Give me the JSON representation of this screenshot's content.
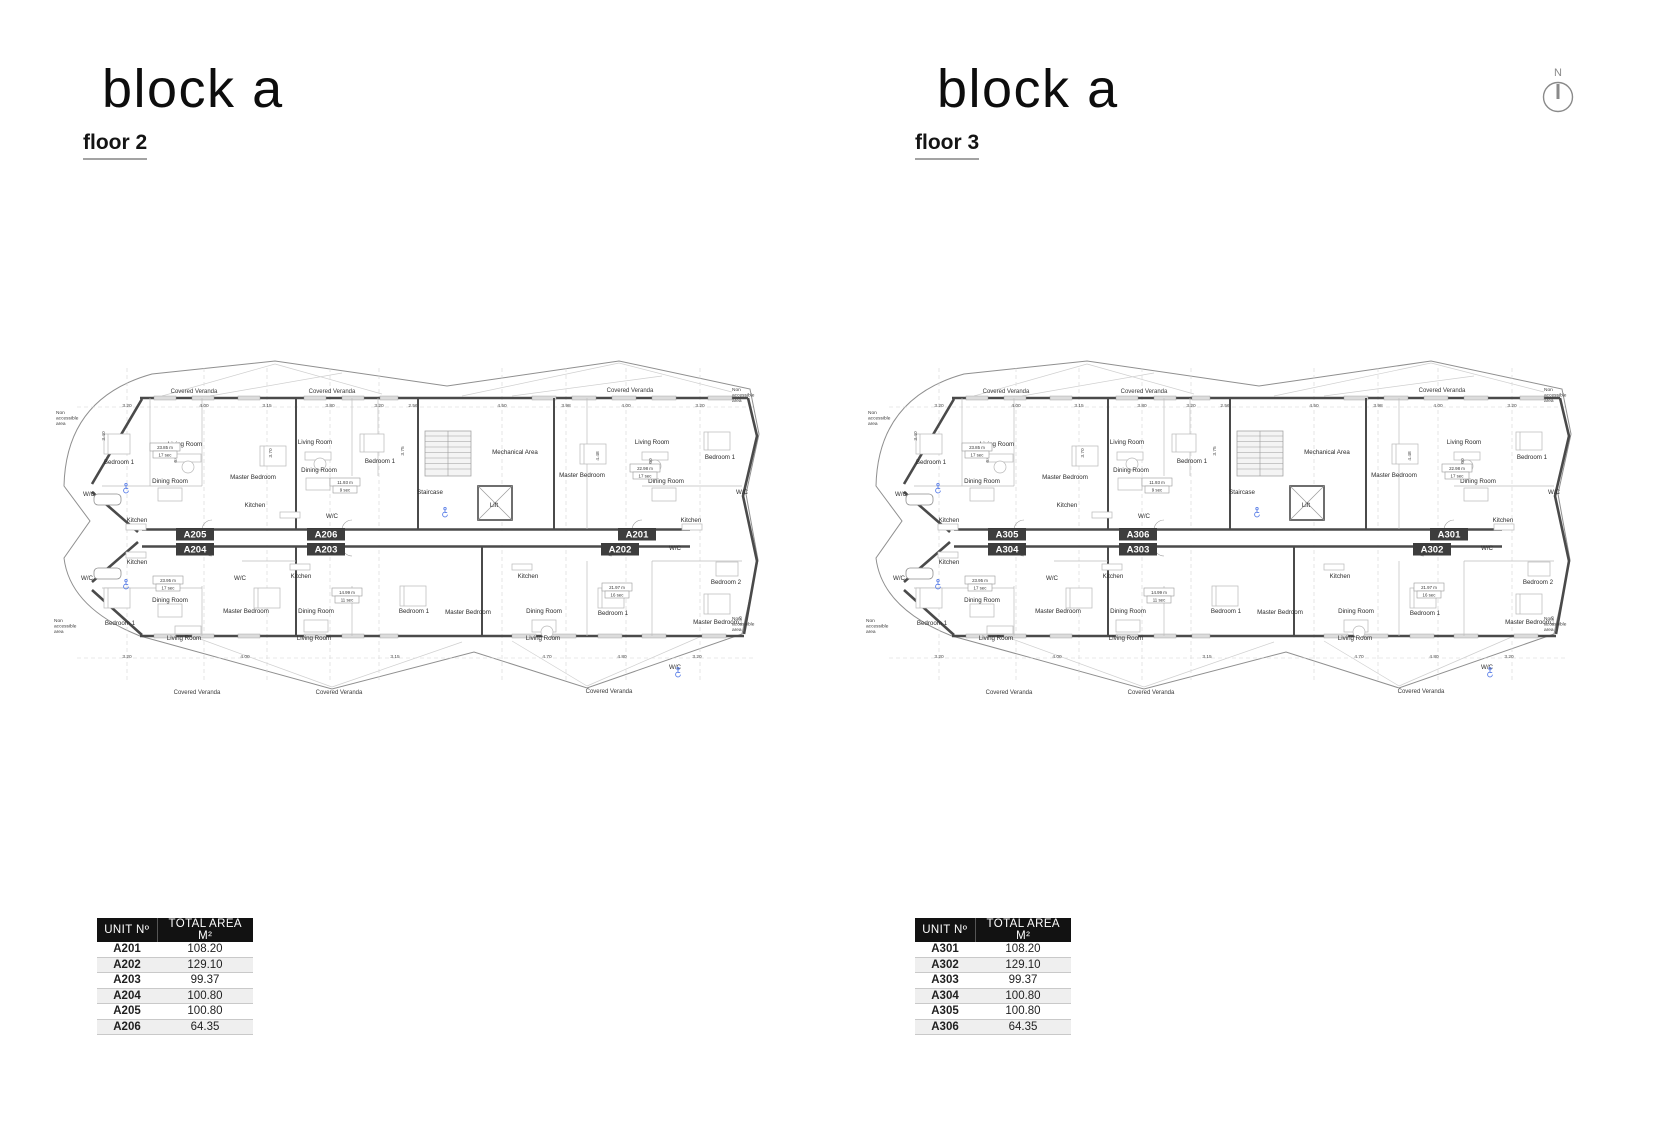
{
  "blocks": [
    {
      "title": "block a",
      "floor_label": "floor 2",
      "units": [
        {
          "id": "A205",
          "row": 0,
          "cx": 153
        },
        {
          "id": "A206",
          "row": 0,
          "cx": 284
        },
        {
          "id": "A201",
          "row": 0,
          "cx": 595
        },
        {
          "id": "A204",
          "row": 1,
          "cx": 153
        },
        {
          "id": "A203",
          "row": 1,
          "cx": 284
        },
        {
          "id": "A202",
          "row": 1,
          "cx": 578
        }
      ],
      "table": {
        "headers": [
          "UNIT Nº",
          "TOTAL AREA M²"
        ],
        "rows": [
          [
            "A201",
            "108.20"
          ],
          [
            "A202",
            "129.10"
          ],
          [
            "A203",
            "99.37"
          ],
          [
            "A204",
            "100.80"
          ],
          [
            "A205",
            "100.80"
          ],
          [
            "A206",
            "64.35"
          ]
        ]
      }
    },
    {
      "title": "block a",
      "floor_label": "floor 3",
      "units": [
        {
          "id": "A305",
          "row": 0,
          "cx": 153
        },
        {
          "id": "A306",
          "row": 0,
          "cx": 284
        },
        {
          "id": "A301",
          "row": 0,
          "cx": 595
        },
        {
          "id": "A304",
          "row": 1,
          "cx": 153
        },
        {
          "id": "A303",
          "row": 1,
          "cx": 284
        },
        {
          "id": "A302",
          "row": 1,
          "cx": 578
        }
      ],
      "table": {
        "headers": [
          "UNIT Nº",
          "TOTAL AREA M²"
        ],
        "rows": [
          [
            "A301",
            "108.20"
          ],
          [
            "A302",
            "129.10"
          ],
          [
            "A303",
            "99.37"
          ],
          [
            "A304",
            "100.80"
          ],
          [
            "A305",
            "100.80"
          ],
          [
            "A306",
            "64.35"
          ]
        ]
      }
    }
  ],
  "north_indicator": {
    "label": "N"
  },
  "floorplan": {
    "veranda_text": "Covered Veranda",
    "veranda_positions": [
      [
        152,
        57
      ],
      [
        290,
        57
      ],
      [
        588,
        56
      ],
      [
        155,
        358
      ],
      [
        297,
        358
      ],
      [
        567,
        357
      ]
    ],
    "non_accessible_text": [
      "Non",
      "accessible",
      "area"
    ],
    "non_accessible_positions": [
      [
        14,
        78
      ],
      [
        12,
        286
      ],
      [
        690,
        55
      ],
      [
        690,
        284
      ]
    ],
    "room_labels": [
      {
        "t": "Bedroom 1",
        "x": 77,
        "y": 128
      },
      {
        "t": "Living Room",
        "x": 143,
        "y": 110
      },
      {
        "t": "Dining Room",
        "x": 128,
        "y": 147
      },
      {
        "t": "Master Bedroom",
        "x": 211,
        "y": 143
      },
      {
        "t": "W/C",
        "x": 47,
        "y": 160
      },
      {
        "t": "Kitchen",
        "x": 95,
        "y": 186
      },
      {
        "t": "Living Room",
        "x": 273,
        "y": 108
      },
      {
        "t": "Dining Room",
        "x": 277,
        "y": 136
      },
      {
        "t": "Bedroom 1",
        "x": 338,
        "y": 127
      },
      {
        "t": "Kitchen",
        "x": 213,
        "y": 171
      },
      {
        "t": "W/C",
        "x": 290,
        "y": 182
      },
      {
        "t": "Staircase",
        "x": 388,
        "y": 158
      },
      {
        "t": "Lift",
        "x": 452,
        "y": 171
      },
      {
        "t": "Mechanical Area",
        "x": 473,
        "y": 118
      },
      {
        "t": "Master Bedroom",
        "x": 540,
        "y": 141
      },
      {
        "t": "Living Room",
        "x": 610,
        "y": 108
      },
      {
        "t": "Dining Room",
        "x": 624,
        "y": 147
      },
      {
        "t": "Bedroom 1",
        "x": 678,
        "y": 123
      },
      {
        "t": "Kitchen",
        "x": 649,
        "y": 186
      },
      {
        "t": "W/C",
        "x": 700,
        "y": 158
      },
      {
        "t": "Kitchen",
        "x": 95,
        "y": 228
      },
      {
        "t": "W/C",
        "x": 45,
        "y": 244
      },
      {
        "t": "W/C",
        "x": 198,
        "y": 244
      },
      {
        "t": "Dining Room",
        "x": 128,
        "y": 266
      },
      {
        "t": "Bedroom 1",
        "x": 78,
        "y": 289
      },
      {
        "t": "Living Room",
        "x": 142,
        "y": 304
      },
      {
        "t": "Master Bedroom",
        "x": 204,
        "y": 277
      },
      {
        "t": "Kitchen",
        "x": 259,
        "y": 242
      },
      {
        "t": "Dining Room",
        "x": 274,
        "y": 277
      },
      {
        "t": "Living Room",
        "x": 272,
        "y": 304
      },
      {
        "t": "Bedroom 1",
        "x": 372,
        "y": 277
      },
      {
        "t": "Master Bedroom",
        "x": 426,
        "y": 278
      },
      {
        "t": "Kitchen",
        "x": 486,
        "y": 242
      },
      {
        "t": "Dining Room",
        "x": 502,
        "y": 277
      },
      {
        "t": "Living Room",
        "x": 501,
        "y": 304
      },
      {
        "t": "Bedroom 1",
        "x": 571,
        "y": 279
      },
      {
        "t": "Master Bedroom",
        "x": 674,
        "y": 288
      },
      {
        "t": "Bedroom 2",
        "x": 684,
        "y": 248
      },
      {
        "t": "W/C",
        "x": 633,
        "y": 214
      },
      {
        "t": "W/C",
        "x": 633,
        "y": 333
      }
    ],
    "dims_top": [
      {
        "v": "3.20",
        "x": 85
      },
      {
        "v": "4.00",
        "x": 162
      },
      {
        "v": "3.15",
        "x": 225
      },
      {
        "v": "3.80",
        "x": 288
      },
      {
        "v": "3.20",
        "x": 337
      },
      {
        "v": "2.56",
        "x": 371
      },
      {
        "v": "4.50",
        "x": 460
      },
      {
        "v": "3.98",
        "x": 524
      },
      {
        "v": "4.00",
        "x": 584
      },
      {
        "v": "3.20",
        "x": 658
      }
    ],
    "dims_bottom": [
      {
        "v": "3.20",
        "x": 85
      },
      {
        "v": "4.00",
        "x": 203
      },
      {
        "v": "3.15",
        "x": 353
      },
      {
        "v": "4.70",
        "x": 505
      },
      {
        "v": "4.80",
        "x": 580
      },
      {
        "v": "3.20",
        "x": 655
      }
    ],
    "dims_vertical": [
      {
        "v": "3.40",
        "x": 63,
        "y": 100
      },
      {
        "v": "6.00",
        "x": 135,
        "y": 122
      },
      {
        "v": "3.70",
        "x": 230,
        "y": 117
      },
      {
        "v": "3.75",
        "x": 362,
        "y": 115
      },
      {
        "v": "4.48",
        "x": 557,
        "y": 120
      },
      {
        "v": "6.00",
        "x": 610,
        "y": 127
      },
      {
        "v": "3.40",
        "x": 700,
        "y": 285
      }
    ],
    "metric_boxes": [
      {
        "l1": "23.85 m",
        "l2": "17 sec",
        "x": 123,
        "y": 113
      },
      {
        "l1": "11.93 m",
        "l2": "9 sec",
        "x": 303,
        "y": 148
      },
      {
        "l1": "22.98 m",
        "l2": "17 sec",
        "x": 603,
        "y": 134
      },
      {
        "l1": "23.95 m",
        "l2": "17 sec",
        "x": 126,
        "y": 246
      },
      {
        "l1": "14.99 m",
        "l2": "11 sec",
        "x": 305,
        "y": 258
      },
      {
        "l1": "21.97 m",
        "l2": "16 sec",
        "x": 575,
        "y": 253
      }
    ],
    "wheelchair_positions": [
      [
        403,
        176
      ],
      [
        84,
        152
      ],
      [
        84,
        248
      ],
      [
        636,
        336
      ]
    ],
    "colors": {
      "wall": "#4a4a4a",
      "light_wall": "#d9d9d9",
      "thin_line": "#c0c0c0",
      "badge_bg": "#3d3d3d",
      "accent_blue": "#5b7fe8",
      "table_header_bg": "#121212",
      "table_alt_row": "#efefef"
    }
  }
}
